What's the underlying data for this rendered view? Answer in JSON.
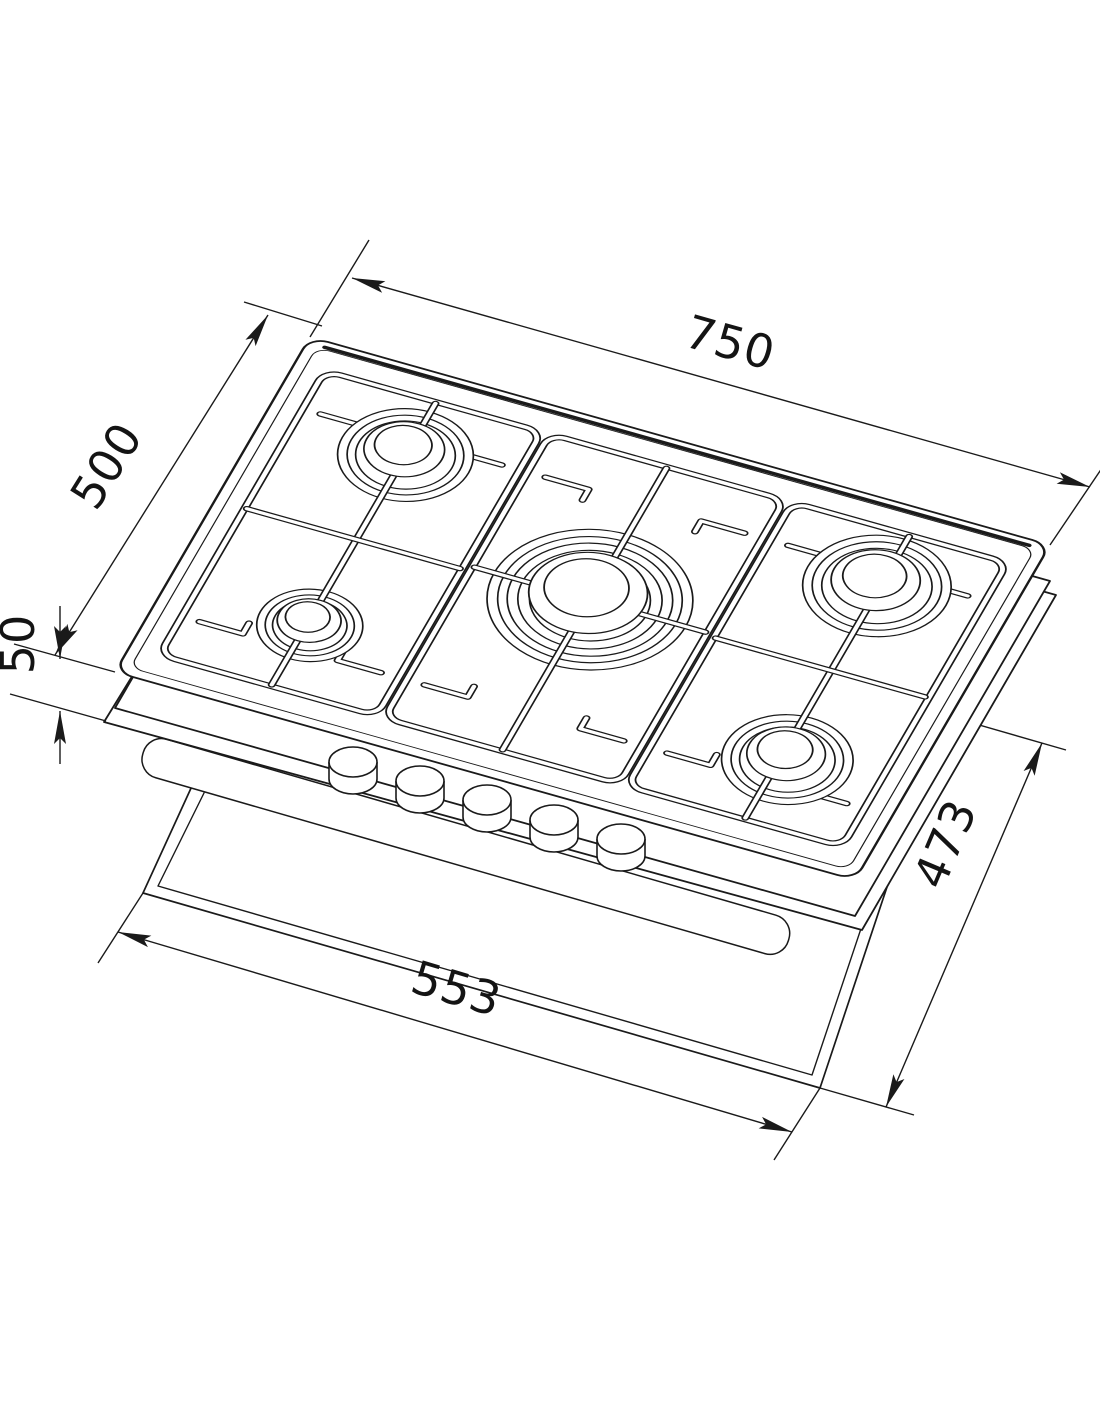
{
  "colors": {
    "line": "#1a1a1a",
    "background": "#ffffff"
  },
  "dims": {
    "width": "750",
    "depth": "500",
    "height": "50",
    "cutout_width": "553",
    "cutout_depth": "473"
  }
}
